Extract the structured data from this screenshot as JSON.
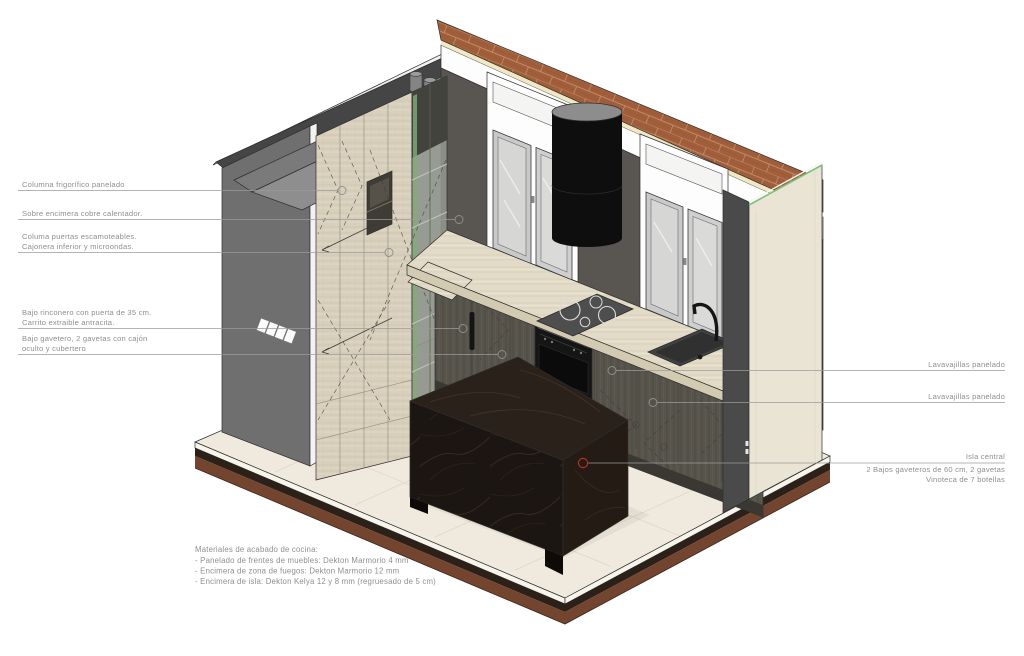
{
  "annotations": {
    "left": [
      {
        "lines": [
          "Columna frigorífico panelado"
        ]
      },
      {
        "lines": [
          "Sobre encimera cobre calentador."
        ]
      },
      {
        "lines": [
          "Columa puertas escamoteables.",
          "Cajonera inferior y microondas."
        ]
      },
      {
        "lines": [
          "Bajo rinconero con puerta de 35 cm.",
          "Carrito extraible antracita."
        ]
      },
      {
        "lines": [
          "Bajo gavetero, 2 gavetas con cajón",
          "oculto y cubertero"
        ]
      }
    ],
    "right": [
      {
        "label": "Lavavajillas panelado"
      },
      {
        "label": "Lavavajillas panelado"
      }
    ],
    "island": {
      "title": "Isla central",
      "line2": "2 Bajos gaveteros de 60 cm,  2 gavetas",
      "line3": "Vinoteca de 7 botellas"
    }
  },
  "notes": {
    "heading": "Materiales de acabado de cocina:",
    "items": [
      "- Panelado de frentes de muebles: Dekton Marmorio 4 mm",
      "- Encimera de zona de fuegos: Dekton Marmorio 12 mm",
      "- Encimera de isla: Dekton Kelya 12 y 8 mm (regruesado de 5 cm)"
    ]
  },
  "colors": {
    "wall_gray": "#6f6f6f",
    "wall_interior": "#595550",
    "brick": "#a15e3b",
    "insulation_green": "#7cc17a",
    "travertine": "#d8d0bc",
    "counter": "#e2dbc7",
    "dark_wood": "#57544b",
    "kelya_black": "#1c1612",
    "floor": "#f0eade",
    "cream_wall": "#e9e4d4",
    "annotation_gray": "#8f8f8f",
    "marker_red": "#b23222"
  }
}
